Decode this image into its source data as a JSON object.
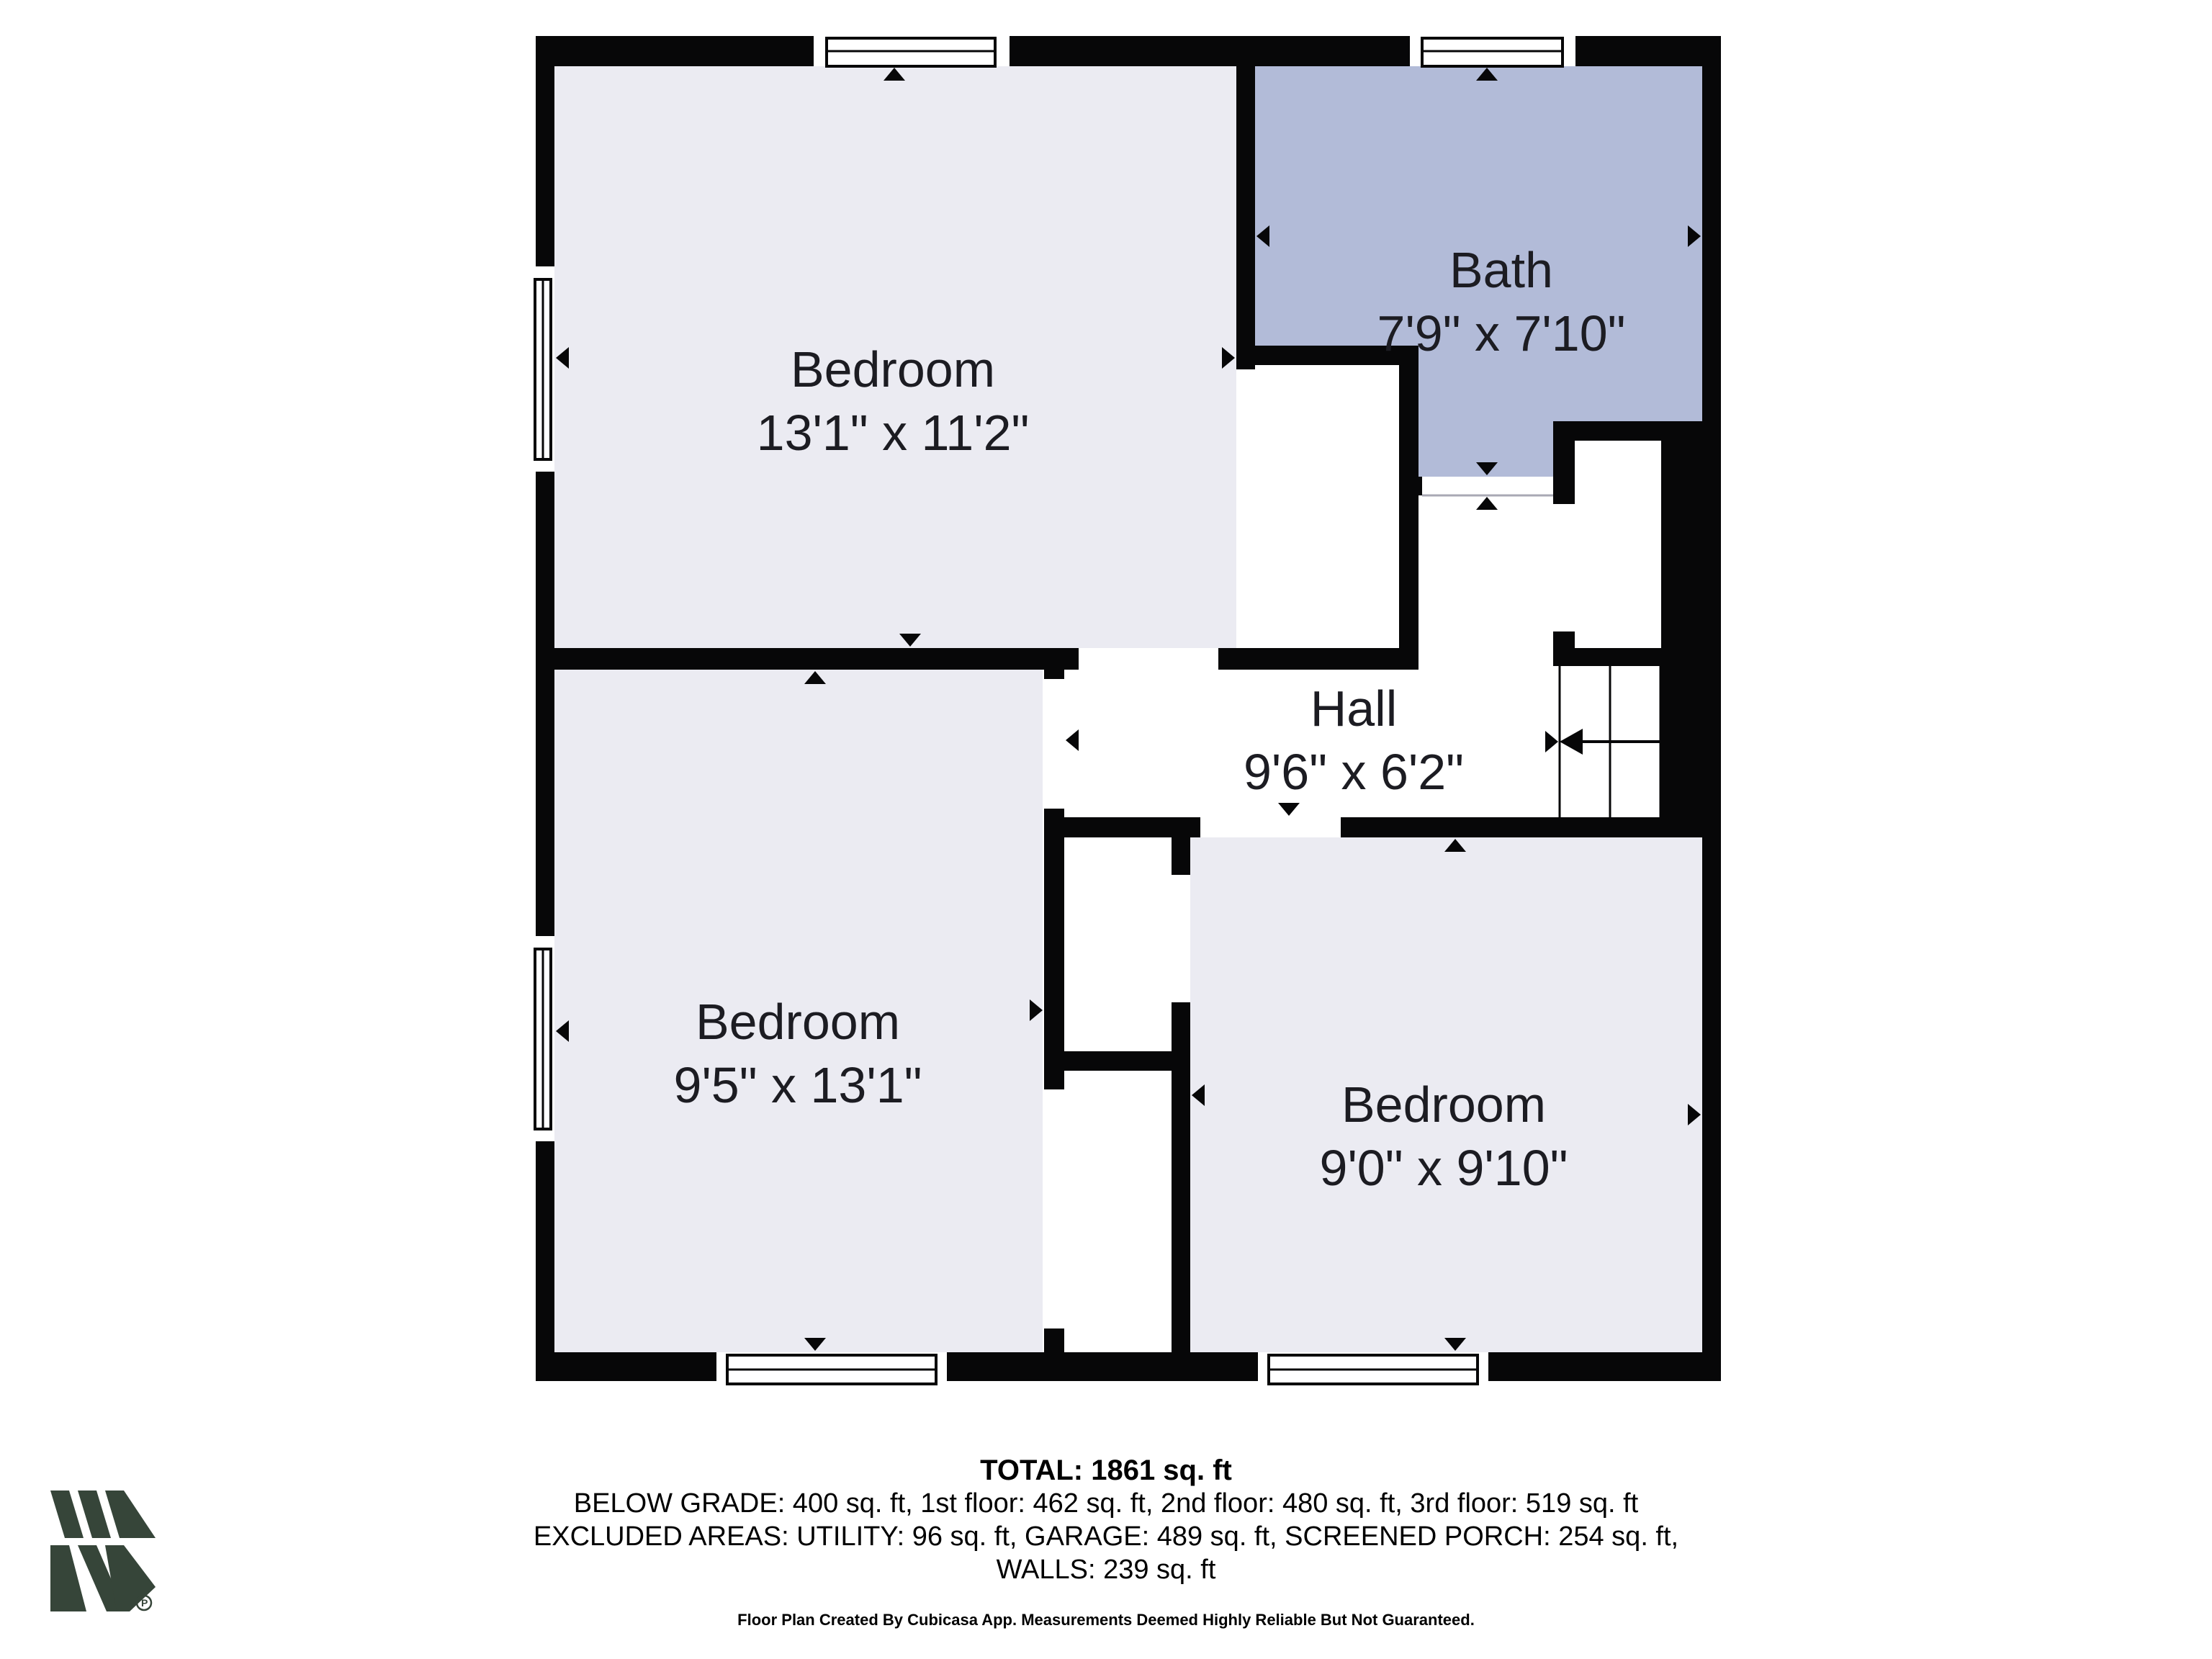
{
  "rooms": [
    {
      "name": "Bedroom",
      "dims": "13'1\" x 11'2\""
    },
    {
      "name": "Bath",
      "dims": "7'9\" x 7'10\""
    },
    {
      "name": "Hall",
      "dims": "9'6\" x 6'2\""
    },
    {
      "name": "Bedroom",
      "dims": "9'5\" x 13'1\""
    },
    {
      "name": "Bedroom",
      "dims": "9'0\" x 9'10\""
    }
  ],
  "summary": {
    "total": "TOTAL: 1861 sq. ft",
    "areas_line1": "BELOW GRADE: 400 sq. ft, 1st floor: 462 sq. ft, 2nd floor: 480 sq. ft, 3rd floor: 519 sq. ft",
    "areas_line2": "EXCLUDED AREAS: UTILITY: 96 sq. ft, GARAGE: 489 sq. ft, SCREENED PORCH: 254 sq. ft,",
    "areas_line3": "WALLS: 239 sq. ft",
    "disclaimer": "Floor Plan Created By Cubicasa App. Measurements Deemed Highly Reliable But Not Guaranteed."
  },
  "logo": {
    "trademark_letter": "P"
  },
  "colors": {
    "wall": "#070708",
    "room": "#ebebf2",
    "bath": "#b2bbd8",
    "text": "#1c1c22",
    "logo": "#364539"
  }
}
